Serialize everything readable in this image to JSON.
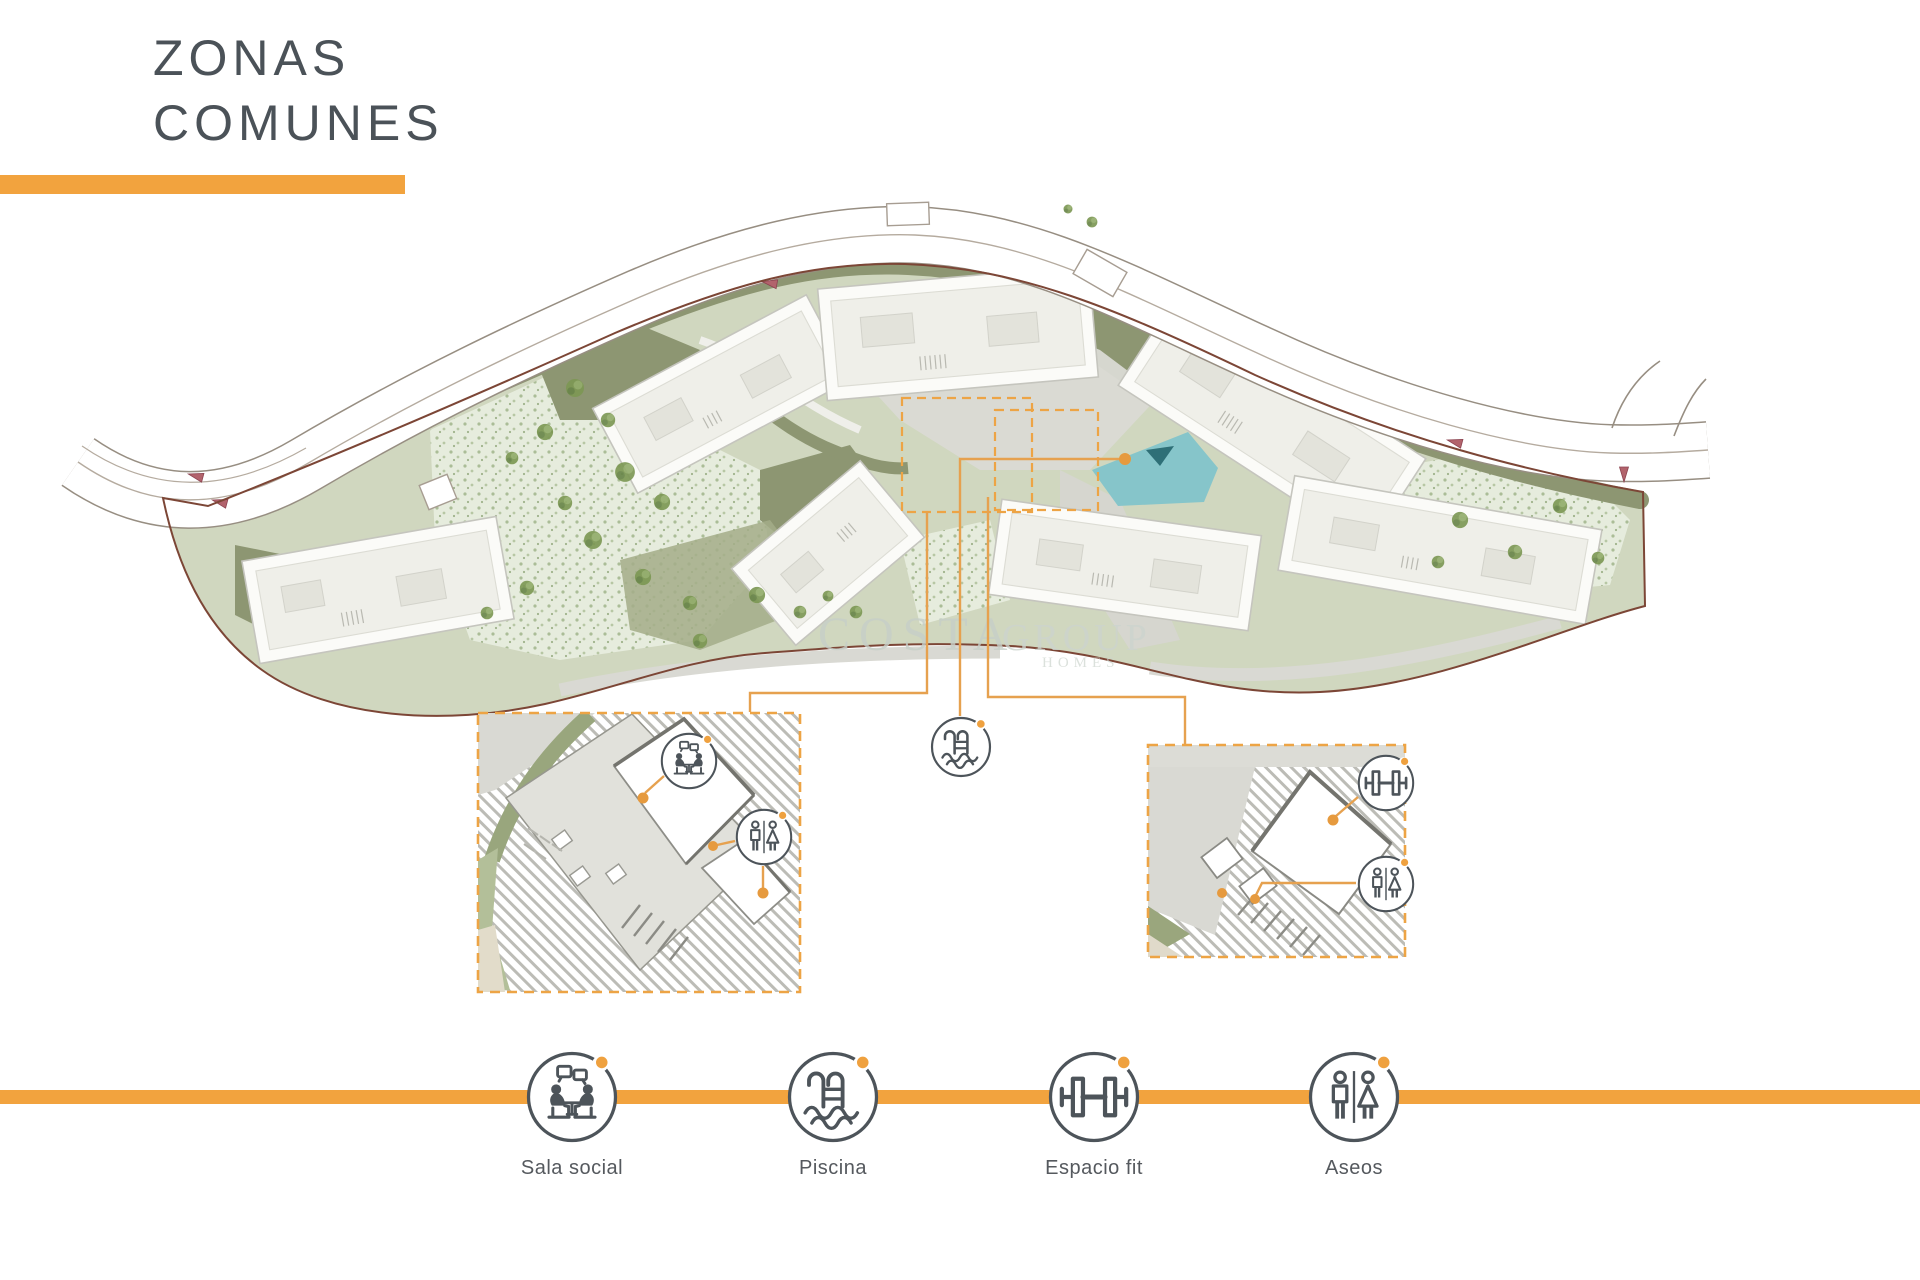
{
  "header": {
    "title_line1": "ZONAS",
    "title_line2": "COMUNES"
  },
  "watermark": {
    "brand": "COSTA",
    "brand2": "GROUP",
    "tagline": "HOMES"
  },
  "plan": {
    "description": "site-plan-with-common-areas",
    "insets": [
      {
        "id": "inset-sala-social",
        "icons": [
          "meeting-icon",
          "wc-icon"
        ]
      },
      {
        "id": "inset-gimnasio",
        "icons": [
          "dumbbell-icon",
          "wc-icon"
        ]
      }
    ],
    "standalone_icon": "pool-icon"
  },
  "legend": {
    "items": [
      {
        "id": "sala-social",
        "label": "Sala social",
        "icon": "meeting-icon"
      },
      {
        "id": "piscina",
        "label": "Piscina",
        "icon": "pool-icon"
      },
      {
        "id": "espacio-fit",
        "label": "Espacio fit",
        "icon": "dumbbell-icon"
      },
      {
        "id": "aseos",
        "label": "Aseos",
        "icon": "wc-icon"
      }
    ]
  },
  "colors": {
    "accent": "#F2A33E",
    "title": "#4B5258",
    "icon_stroke": "#4D545A",
    "pool_water": "#86C5CA",
    "leader": "#E6A14F",
    "boundary": "#7C4636",
    "olive": "#8D9672"
  }
}
